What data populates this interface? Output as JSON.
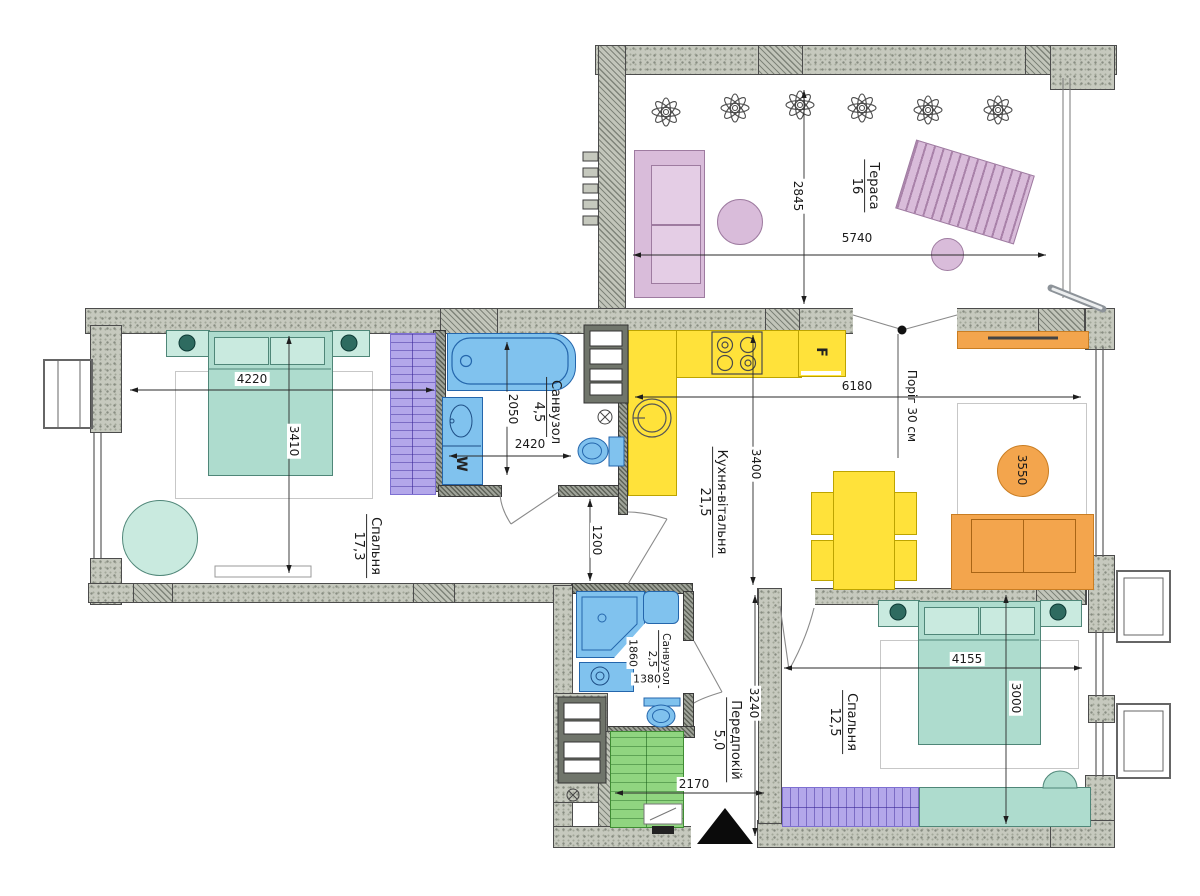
{
  "rooms": [
    {
      "id": "terrace",
      "name": "Тераса",
      "area": "16"
    },
    {
      "id": "bedroom-1",
      "name": "Спальня",
      "area": "17,3"
    },
    {
      "id": "bathroom-1",
      "name": "Санвузол",
      "area": "4,5"
    },
    {
      "id": "kitchen",
      "name": "Кухня-вітальня",
      "area": "21,5"
    },
    {
      "id": "bathroom-2",
      "name": "Санвузол",
      "area": "2,5"
    },
    {
      "id": "hallway",
      "name": "Передпокій",
      "area": "5,0"
    },
    {
      "id": "bedroom-2",
      "name": "Спальня",
      "area": "12,5"
    }
  ],
  "dimensions_mm": {
    "terrace_depth": "2845",
    "terrace_width": "5740",
    "bedroom1_width": "4220",
    "bedroom1_depth": "3410",
    "bathroom1_depth": "2050",
    "bathroom1_width": "2420",
    "passage_width": "1200",
    "kitchen_depth": "3400",
    "kitchen_width": "6180",
    "living_rug": "3550",
    "bathroom2_depth": "1860",
    "bathroom2_width": "1380",
    "hallway_depth": "3240",
    "hallway_width": "2170",
    "bedroom2_width": "4155",
    "bedroom2_depth": "3000"
  },
  "notes": {
    "threshold": "Поріг 30 см"
  },
  "appliances": {
    "fridge_label": "F",
    "washer_label": "W"
  },
  "colors": {
    "wall": "#c6c9be",
    "teal": "#aedcce",
    "purple": "#b3a7ea",
    "blue": "#80c2ee",
    "yellow": "#ffe23a",
    "orange": "#f3a54d",
    "pink": "#d9bcda",
    "green": "#90d580"
  }
}
